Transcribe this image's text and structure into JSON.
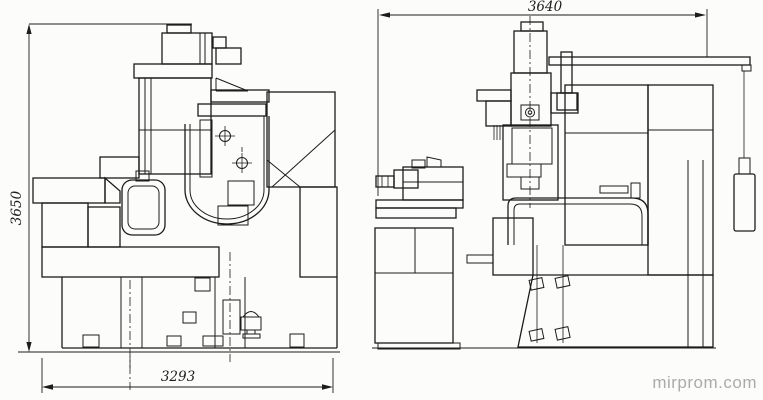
{
  "colors": {
    "ink": "#1c1c1c",
    "paper": "#fcfcfa",
    "watermark": "#ababab"
  },
  "dimensions": {
    "side_height": "3650",
    "side_width": "3293",
    "front_width": "3640"
  },
  "watermark": {
    "text": "mirprom.com"
  }
}
